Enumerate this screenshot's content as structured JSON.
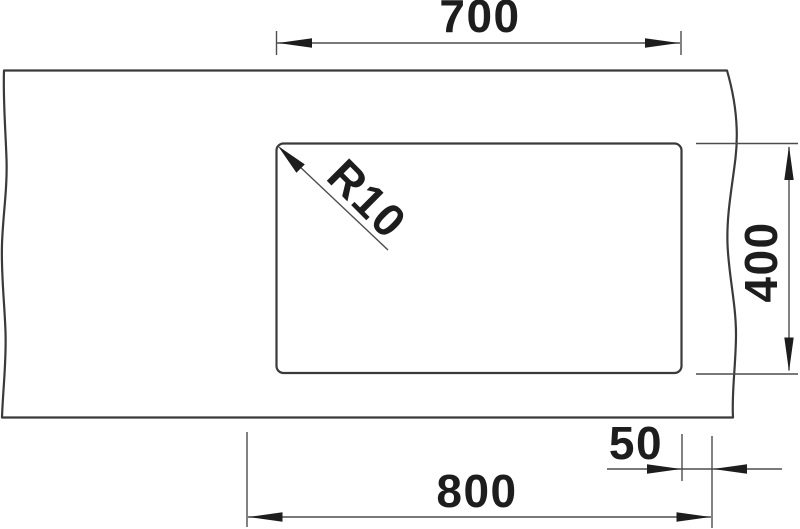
{
  "drawing": {
    "dimensions": {
      "bowl_width": "700",
      "bowl_depth": "400",
      "overall_width": "800",
      "edge_offset": "50",
      "corner_radius": "R10"
    },
    "colors": {
      "background": "#ffffff",
      "outline": "#3a3a3a",
      "dimension_line": "#4d4d4d",
      "text": "#1d1d1d"
    }
  }
}
